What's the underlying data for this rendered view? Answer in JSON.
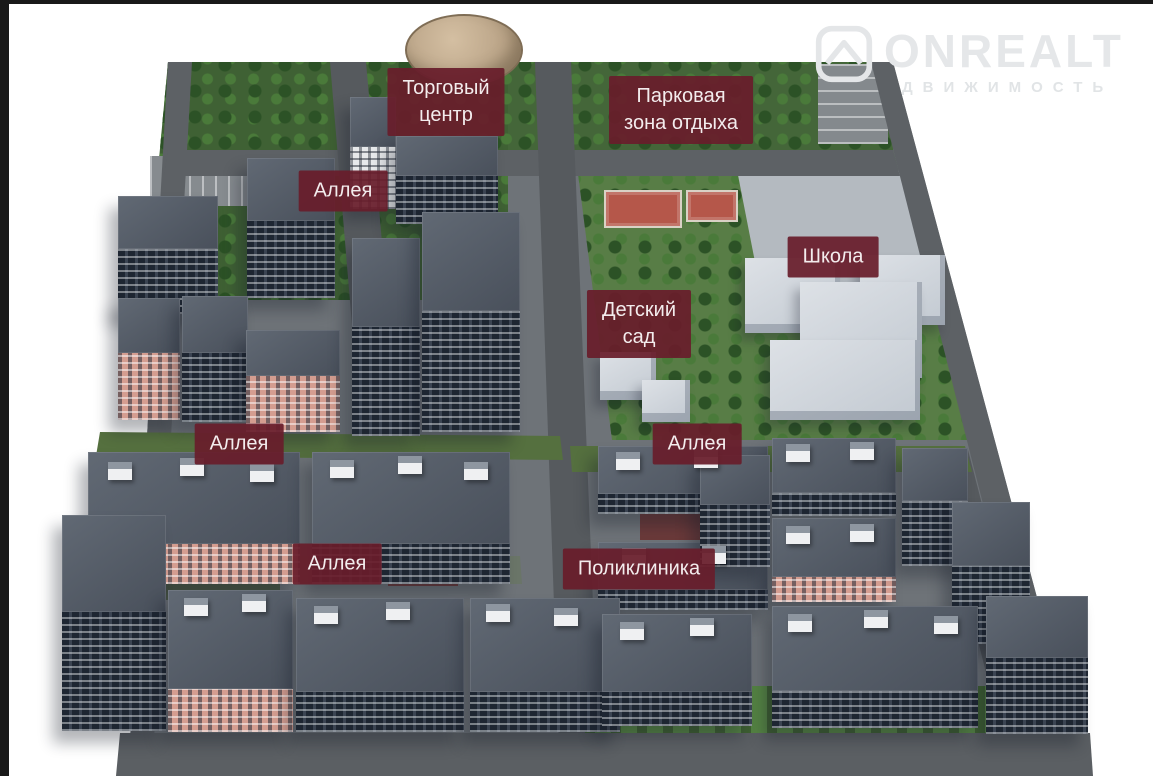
{
  "watermark": {
    "brand": "ONREALT",
    "subtitle": "ДВИЖИМОСТЬ",
    "icon": "roof-logo-icon",
    "color": "#e5e7e9"
  },
  "map_labels": [
    {
      "id": "shopping-center",
      "text": "Торговый\nцентр"
    },
    {
      "id": "park-zone",
      "text": "Парковая\nзона отдыха"
    },
    {
      "id": "alley-1",
      "text": "Аллея"
    },
    {
      "id": "school",
      "text": "Школа"
    },
    {
      "id": "kindergarten",
      "text": "Детский\nсад"
    },
    {
      "id": "alley-2",
      "text": "Аллея"
    },
    {
      "id": "alley-3",
      "text": "Аллея"
    },
    {
      "id": "alley-4",
      "text": "Аллея"
    },
    {
      "id": "polyclinic",
      "text": "Поликлиника"
    }
  ],
  "colors": {
    "label_background": "#681d2b",
    "label_text": "#f3eced",
    "park_green": "#3f6134",
    "light_green": "#587d46",
    "road_gray": "#5d6165",
    "building_roof": "#535b66",
    "building_facade_dark": "#222a36",
    "building_facade_salmon": "#d49d90",
    "sport_court": "#b5574a",
    "school_building": "#d3d8de",
    "frame": "#191919",
    "background": "#ffffff"
  }
}
